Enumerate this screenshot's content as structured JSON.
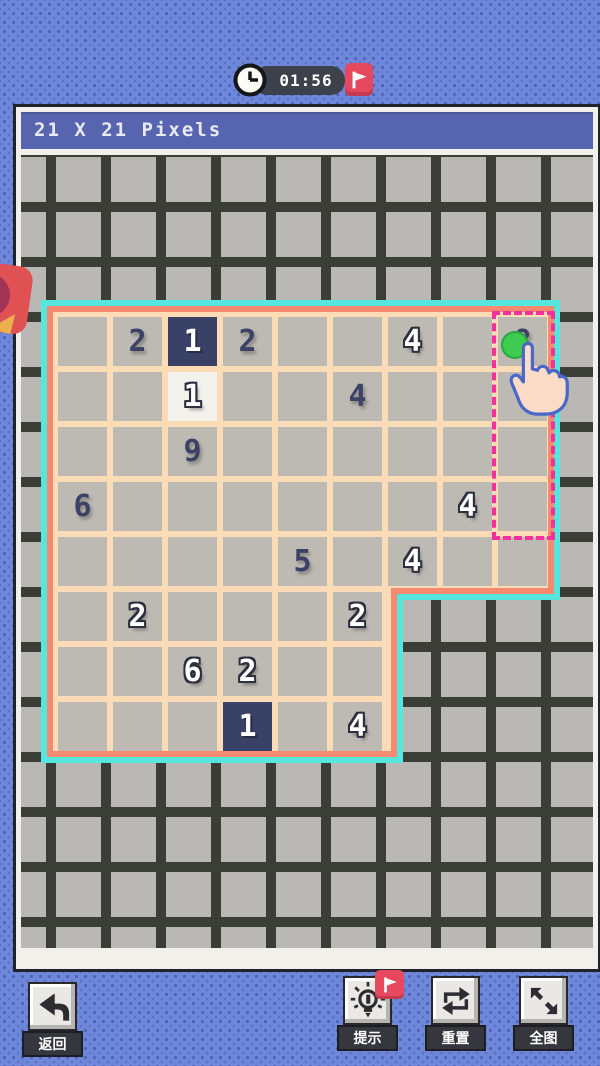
{
  "header": {
    "title": "21 X 21 Pixels"
  },
  "timer": {
    "time": "01:56",
    "clock_icon": "clock-icon",
    "flag_button_icon": "flag-icon"
  },
  "puzzle": {
    "shape": "L",
    "blocks": [
      {
        "rows": [
          0,
          4
        ],
        "cols": [
          0,
          8
        ]
      },
      {
        "rows": [
          5,
          7
        ],
        "cols": [
          0,
          5
        ]
      }
    ],
    "cells": [
      {
        "row": 0,
        "col": 1,
        "value": "2",
        "variant": "clue-dark"
      },
      {
        "row": 0,
        "col": 2,
        "value": "1",
        "variant": "fill-navy"
      },
      {
        "row": 0,
        "col": 3,
        "value": "2",
        "variant": "clue-dark"
      },
      {
        "row": 0,
        "col": 6,
        "value": "4",
        "variant": "clue-white"
      },
      {
        "row": 0,
        "col": 8,
        "value": "8",
        "variant": "clue-dark",
        "note": "occluded-by-touch-indicator"
      },
      {
        "row": 1,
        "col": 2,
        "value": "1",
        "variant": "fill-white"
      },
      {
        "row": 1,
        "col": 5,
        "value": "4",
        "variant": "clue-dark"
      },
      {
        "row": 2,
        "col": 2,
        "value": "9",
        "variant": "clue-dark"
      },
      {
        "row": 3,
        "col": 0,
        "value": "6",
        "variant": "clue-dark"
      },
      {
        "row": 3,
        "col": 7,
        "value": "4",
        "variant": "clue-white"
      },
      {
        "row": 4,
        "col": 4,
        "value": "5",
        "variant": "clue-dark"
      },
      {
        "row": 4,
        "col": 6,
        "value": "4",
        "variant": "clue-white"
      },
      {
        "row": 5,
        "col": 1,
        "value": "2",
        "variant": "clue-white"
      },
      {
        "row": 5,
        "col": 5,
        "value": "2",
        "variant": "clue-white"
      },
      {
        "row": 6,
        "col": 2,
        "value": "6",
        "variant": "clue-white"
      },
      {
        "row": 6,
        "col": 3,
        "value": "2",
        "variant": "clue-white"
      },
      {
        "row": 7,
        "col": 3,
        "value": "1",
        "variant": "fill-navy"
      },
      {
        "row": 7,
        "col": 5,
        "value": "4",
        "variant": "clue-white"
      }
    ],
    "selection": {
      "col": 8,
      "row_start": 0,
      "row_end": 3
    }
  },
  "bottom_bar": {
    "back": {
      "label": "返回",
      "icon": "back-arrow-icon"
    },
    "hint": {
      "label": "提示",
      "icon": "lightbulb-icon",
      "badge_icon": "flag-icon"
    },
    "reset": {
      "label": "重置",
      "icon": "reset-loop-icon"
    },
    "fullview": {
      "label": "全图",
      "icon": "expand-icon"
    }
  },
  "colors": {
    "background": "#6f87d8",
    "background_dot": "#4f63ba",
    "header_bar": "#5765b1",
    "panel_frame": "#f1f0ea",
    "panel_border": "#20222c",
    "grid_line": "#3b3d37",
    "grid_cell": "#b9b8b4",
    "puzzle_peach": "#fcdcb7",
    "puzzle_border_salmon": "#f58a71",
    "puzzle_border_cyan": "#55e6de",
    "cell_gray": "#bdb9b3",
    "cell_navy": "#3a4166",
    "cell_white": "#f4f2ed",
    "clue_navy_text": "#3b4266",
    "selection_pink": "#f5309b",
    "touch_green": "#3ecb52",
    "accent_red": "#e6495e",
    "timer_pill": "#3d414b"
  }
}
